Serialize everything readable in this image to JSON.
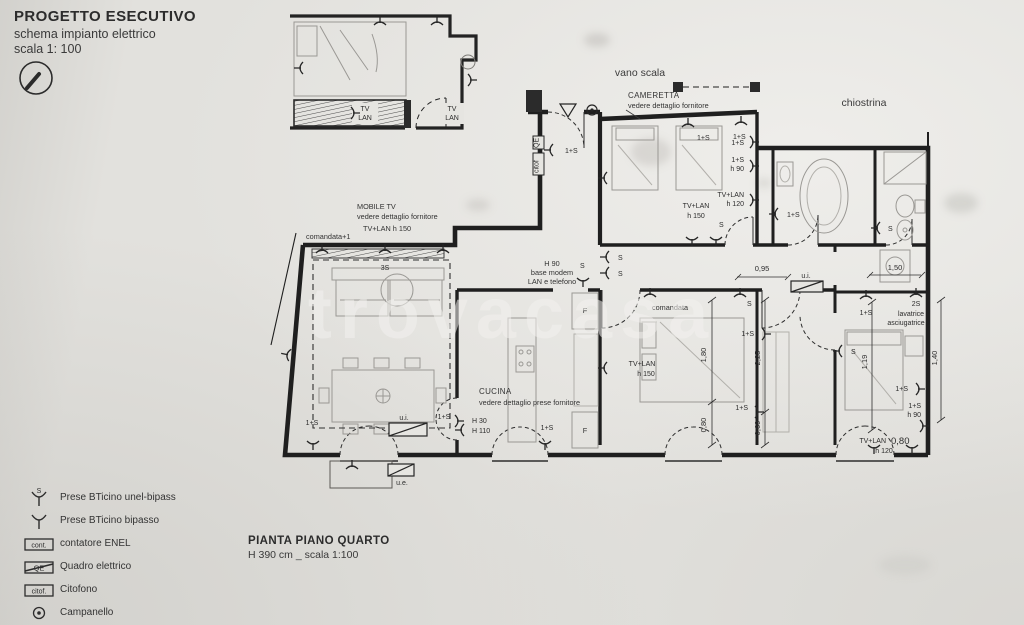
{
  "header": {
    "title": "PROGETTO ESECUTIVO",
    "subtitle": "schema impianto elettrico",
    "scale": "scala 1: 100"
  },
  "footer": {
    "title": "PIANTA PIANO QUARTO",
    "subtitle": "H 390 cm _ scala 1:100"
  },
  "watermark": "trovacasa",
  "legend": {
    "items": [
      {
        "label": "Prese BTicino unel-bipass"
      },
      {
        "label": "Prese BTicino bipasso"
      },
      {
        "box": "cont.",
        "label": "contatore ENEL"
      },
      {
        "box": "QE",
        "label": "Quadro elettrico"
      },
      {
        "box": "citof.",
        "label": "Citofono"
      },
      {
        "label": "Campanello"
      }
    ]
  },
  "rooms": {
    "vano_scala": "vano scala",
    "chiostrina": "chiostrina",
    "cameretta": "CAMERETTA",
    "cameretta_note": "vedere dettaglio fornitore",
    "cucina": "CUCINA",
    "cucina_note": "vedere dettaglio prese fornitore",
    "mobile_tv": "MOBILE TV",
    "mobile_tv_note": "vedere dettaglio fornitore",
    "mobile_tv_height": "TV+LAN h 150"
  },
  "labels": {
    "s": "S",
    "uno_s": "1+S",
    "due_s": "2S",
    "tre_s": "3S",
    "h30": "H 30",
    "h110": "H 110",
    "h90": "h 90",
    "h120": "h 120",
    "h150": "h 150",
    "tv_lan": "TV+LAN",
    "tv": "TV",
    "lan": "LAN",
    "f": "F",
    "ui": "u.i.",
    "ue": "u.e.",
    "comandata": "comandata",
    "comandata_plus1": "comandata+1",
    "modem_1": "H 90",
    "modem_2": "base modem",
    "modem_3": "LAN e telefono",
    "lavatrice_1": "lavatrice",
    "lavatrice_2": "asciugatrice",
    "qe": "QE",
    "citof": "citof"
  },
  "dims": {
    "d095": "0,95",
    "d150": "1,50",
    "d180": "1,80",
    "d080": "0,80",
    "d225": "2,25",
    "d069": "0,69",
    "d119": "1,19",
    "d140": "1,40"
  }
}
